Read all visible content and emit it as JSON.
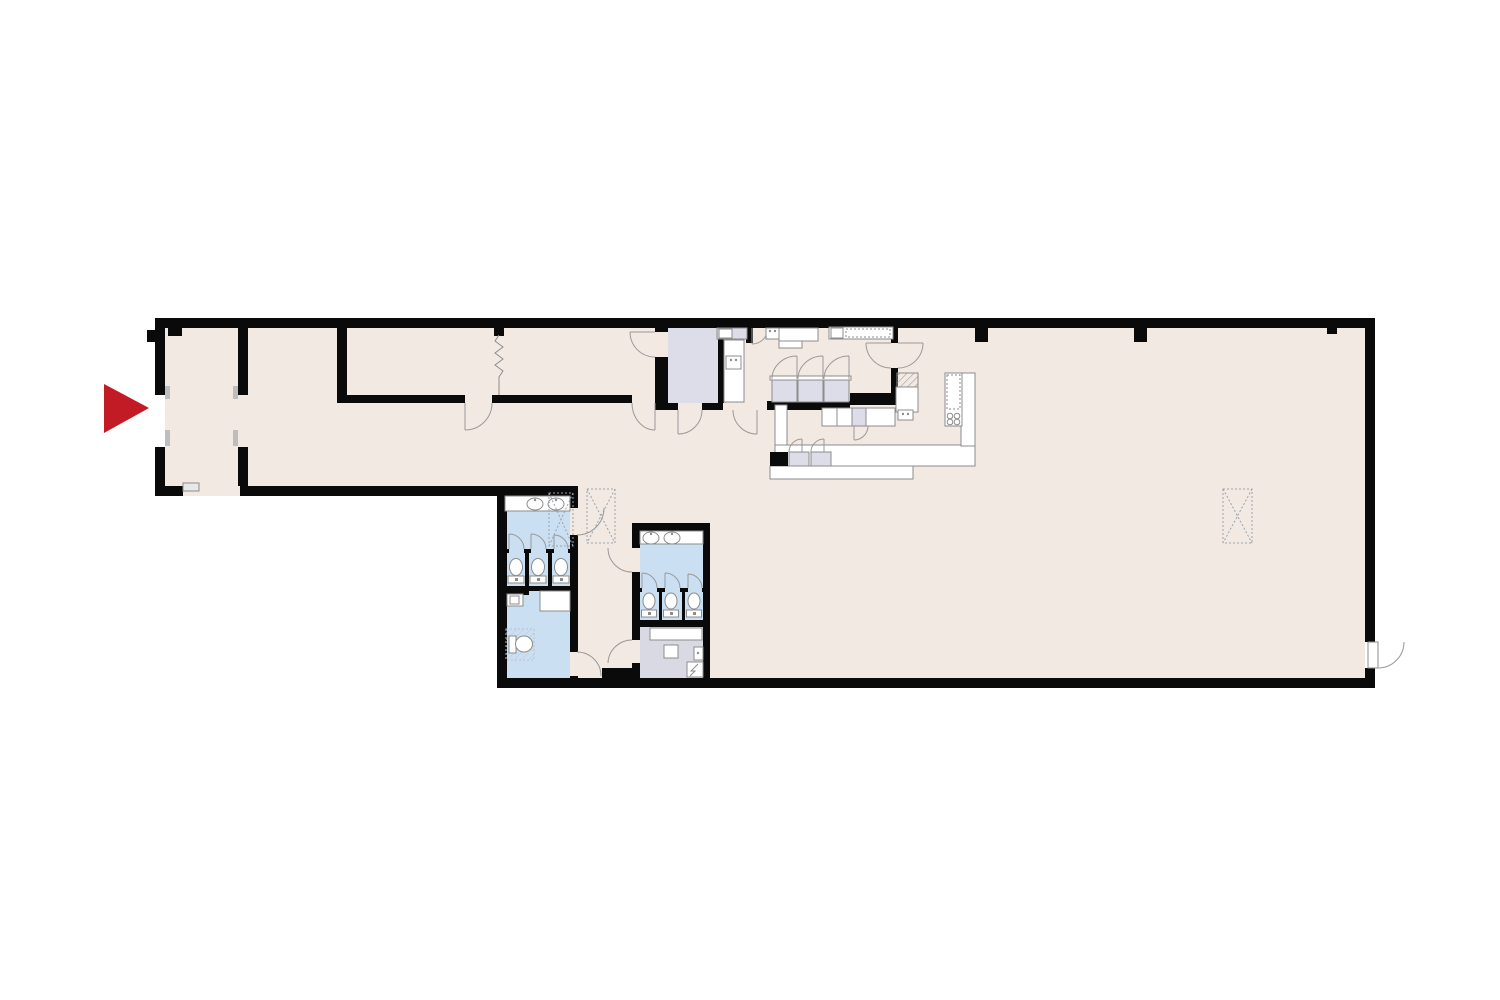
{
  "colors": {
    "background": "#ffffff",
    "wall": "#0a0a0a",
    "floor": "#f2e9e3",
    "restroom_blue": "#cbdff2",
    "cabinet_lavender": "#dcdde9",
    "utility_gray": "#d8d9e2",
    "fixture_line": "#8c8c8c",
    "door_arc": "#999999",
    "dashed": "#9aa3ad",
    "accent_red": "#c21b26",
    "jamb_gray": "#bdbdbd"
  },
  "plan": {
    "entrance_marker": {
      "icon": "triangle-right-icon",
      "color": "#c21b26"
    },
    "restroom_left": {
      "sinks": 2,
      "stalls": 3,
      "toilets": 4,
      "accessible_room": 1
    },
    "restroom_right": {
      "sinks": 2,
      "stalls": 3,
      "toilets": 3
    },
    "kitchen": {
      "stove_burners": 4,
      "cabinet_doors": 3,
      "island_fridges": 2,
      "service_double_doors": 2
    },
    "dashed_ceiling_boxes": 3,
    "top_wall_pillars": 4,
    "exit_doors": 1
  }
}
